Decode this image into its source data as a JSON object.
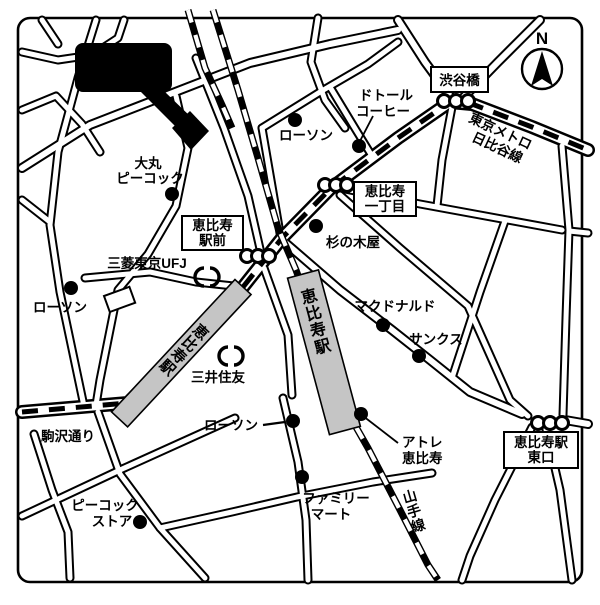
{
  "marker": {
    "site": "現地"
  },
  "compass": {
    "north": "N"
  },
  "boxes": {
    "shibuyabashi": "渋谷橋",
    "itchome1": "恵比寿",
    "itchome2": "一丁目",
    "ekimae1": "恵比寿",
    "ekimae2": "駅前",
    "east1": "恵比寿駅",
    "east2": "東口"
  },
  "lines": {
    "metro1": "東京メトロ",
    "metro2": "日比谷線",
    "yamanote": "山手線",
    "station_hibiya": "恵比寿駅",
    "station_jr": "恵比寿駅",
    "komazawa": "駒沢通り"
  },
  "pois": {
    "daimaru1": "大丸",
    "daimaru2": "ピーコック",
    "lawson_north": "ローソン",
    "doutor1": "ドトール",
    "doutor2": "コーヒー",
    "suginokiya": "杉の木屋",
    "ufj": "三菱東京UFJ",
    "smbc": "三井住友",
    "lawson_west": "ローソン",
    "mcdonalds": "マクドナルド",
    "sunkus": "サンクス",
    "lawson_south": "ローソン",
    "atre1": "アトレ",
    "atre2": "恵比寿",
    "famima1": "ファミリー",
    "famima2": "マート",
    "peacock1": "ピーコック",
    "peacock2": "ストア"
  },
  "colors": {
    "ink": "#000000",
    "station_fill": "#c5c5c5",
    "bg": "#ffffff"
  }
}
